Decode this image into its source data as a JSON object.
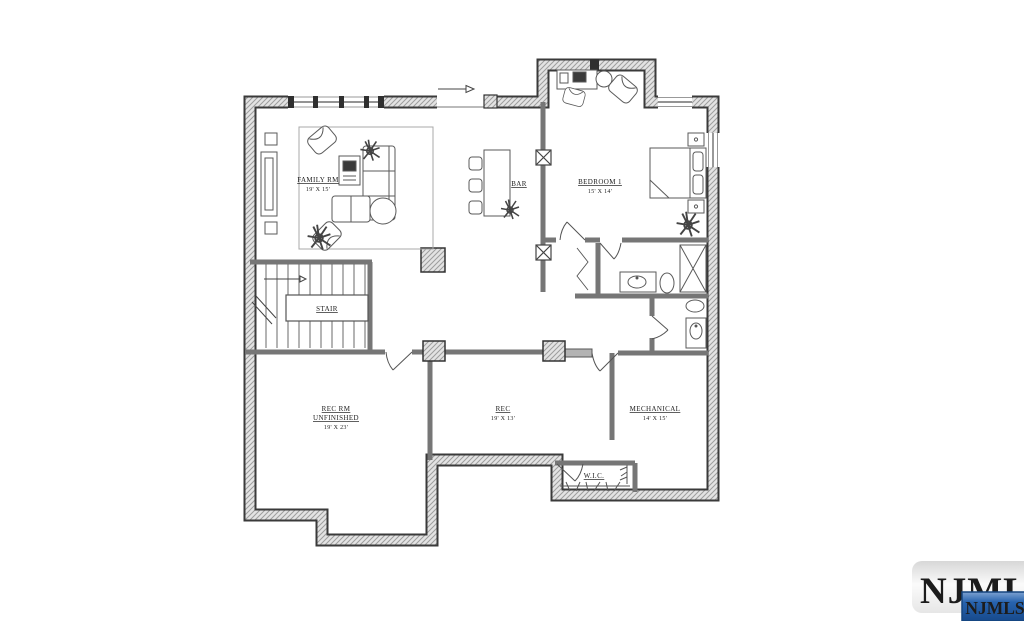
{
  "floorplan": {
    "rooms": {
      "family": {
        "name": "FAMILY RM",
        "dims": "19' X 15'"
      },
      "bar": {
        "name": "BAR"
      },
      "bedroom1": {
        "name": "BEDROOM 1",
        "dims": "15' X 14'"
      },
      "stair": {
        "name": "STAIR"
      },
      "rec_rm": {
        "name": "REC RM",
        "status": "UNFINISHED",
        "dims": "19' X 23'"
      },
      "rec": {
        "name": "REC",
        "dims": "19' X 13'"
      },
      "mechanical": {
        "name": "MECHANICAL",
        "dims": "14' X 15'"
      },
      "wic": {
        "name": "W.I.C."
      }
    }
  },
  "watermark": {
    "logo_text": "NJMLS",
    "badge_text": "NJMLS",
    "badge_color": "#2763ae",
    "logo_color": "#c3c9d1"
  }
}
